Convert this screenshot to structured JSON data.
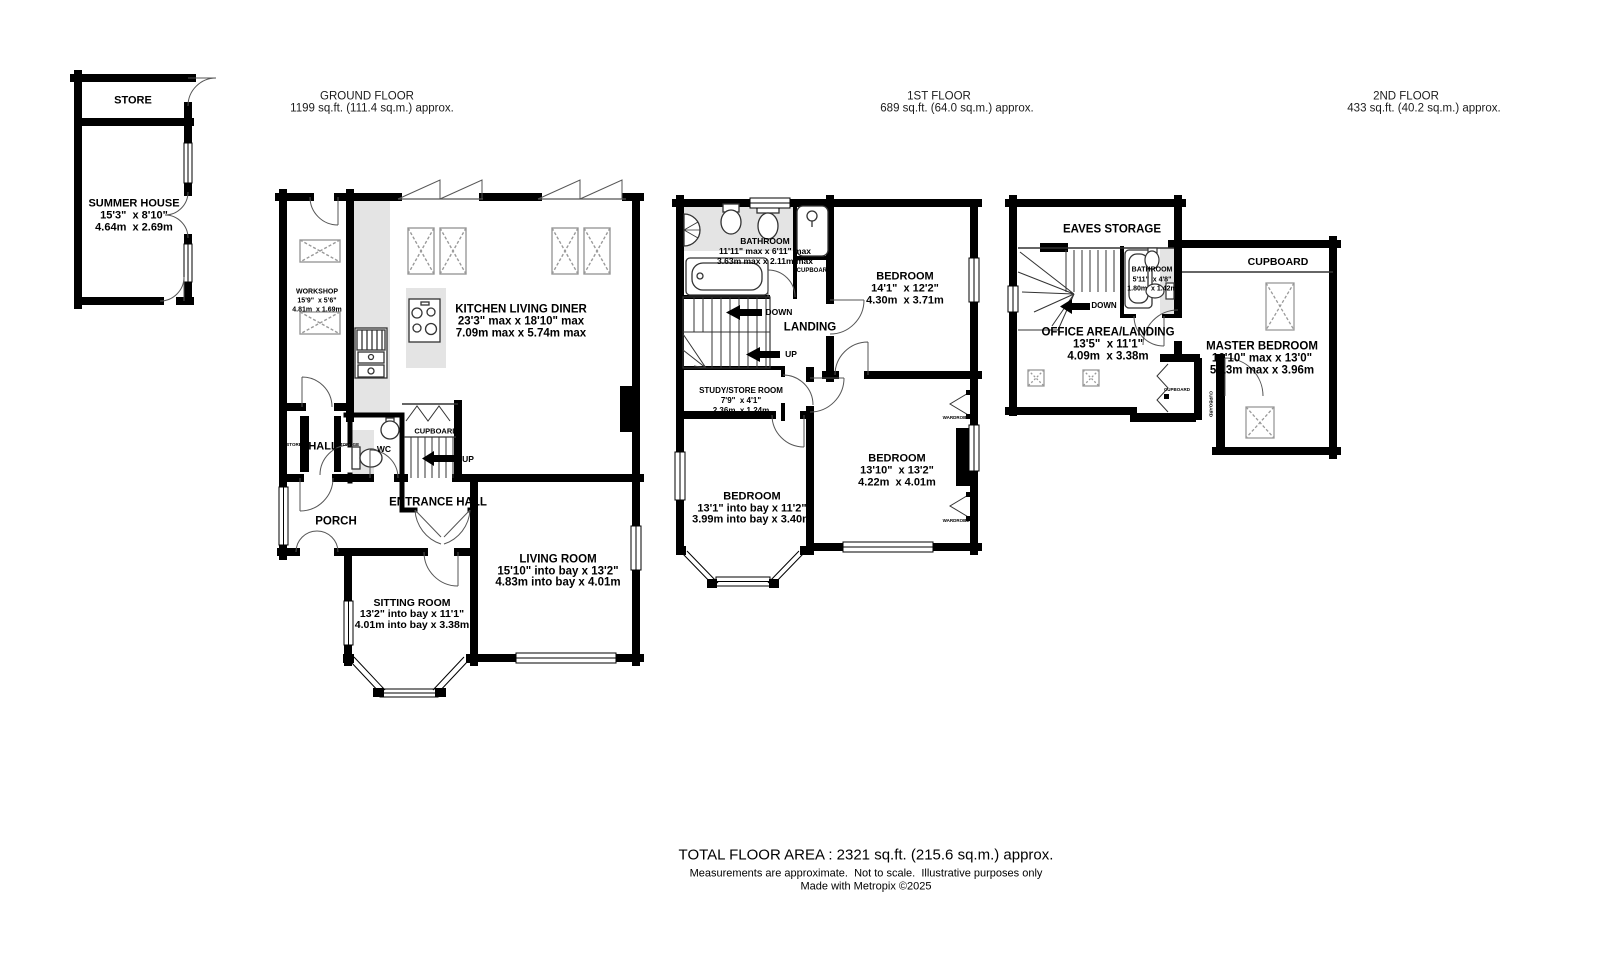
{
  "headers": {
    "ground": {
      "title": "GROUND FLOOR",
      "area": "1199 sq.ft. (111.4 sq.m.) approx."
    },
    "first": {
      "title": "1ST FLOOR",
      "area": "689 sq.ft. (64.0 sq.m.) approx."
    },
    "second": {
      "title": "2ND FLOOR",
      "area": "433 sq.ft. (40.2 sq.m.) approx."
    }
  },
  "outbuilding": {
    "store": "STORE",
    "summer_house": {
      "name": "SUMMER HOUSE",
      "dims_ft": "15'3\"  x 8'10\"",
      "dims_m": "4.64m  x 2.69m"
    }
  },
  "ground": {
    "workshop": {
      "name": "WORKSHOP",
      "dims_ft": "15'9\"  x 5'6\"",
      "dims_m": "4.81m  x 1.69m"
    },
    "kitchen": {
      "name": "KITCHEN LIVING DINER",
      "dims_ft": "23'3\" max x 18'10\" max",
      "dims_m": "7.09m max x 5.74m max"
    },
    "hall": "HALL",
    "store_closet": "STORE",
    "storage_closet": "STORAGE",
    "wc": "WC",
    "cupboard": "CUPBOARD",
    "up": "UP",
    "entrance_hall": "ENTRANCE HALL",
    "porch": "PORCH",
    "sitting": {
      "name": "SITTING ROOM",
      "dims_ft": "13'2\" into bay x 11'1\"",
      "dims_m": "4.01m into bay x 3.38m"
    },
    "living": {
      "name": "LIVING ROOM",
      "dims_ft": "15'10\" into bay x 13'2\"",
      "dims_m": "4.83m into bay x 4.01m"
    }
  },
  "first": {
    "bathroom": {
      "name": "BATHROOM",
      "dims_ft": "11'11\" max x 6'11\" max",
      "dims_m": "3.63m max x 2.11m max"
    },
    "cupboard": "CUPBOARD",
    "down": "DOWN",
    "up": "UP",
    "landing": "LANDING",
    "study": {
      "name": "STUDY/STORE ROOM",
      "dims_ft": "7'9\"  x 4'1\"",
      "dims_m": "2.36m  x 1.24m"
    },
    "bedroom1": {
      "name": "BEDROOM",
      "dims_ft": "14'1\"  x 12'2\"",
      "dims_m": "4.30m  x 3.71m"
    },
    "bedroom2": {
      "name": "BEDROOM",
      "dims_ft": "13'10\"  x 13'2\"",
      "dims_m": "4.22m  x 4.01m"
    },
    "bedroom3": {
      "name": "BEDROOM",
      "dims_ft": "13'1\" into bay x 11'2\"",
      "dims_m": "3.99m into bay x 3.40m"
    },
    "wardrobe": "WARDROBE"
  },
  "second": {
    "eaves": "EAVES STORAGE",
    "down": "DOWN",
    "bathroom": {
      "name": "BATHROOM",
      "dims_ft": "5'11\"  x 4'8\"",
      "dims_m": "1.80m  x 1.42m"
    },
    "office": {
      "name": "OFFICE AREA/LANDING",
      "dims_ft": "13'5\"  x 11'1\"",
      "dims_m": "4.09m  x 3.38m"
    },
    "cupboard": "CUPBOARD",
    "cupboard_small": "CUPBOARD",
    "master": {
      "name": "MASTER BEDROOM",
      "dims_ft": "16'10\" max x 13'0\"",
      "dims_m": "5.13m max x 3.96m"
    }
  },
  "footer": {
    "total": "TOTAL FLOOR AREA : 2321 sq.ft. (215.6 sq.m.) approx.",
    "disclaimer": "Measurements are approximate.  Not to scale.  Illustrative purposes only",
    "credit": "Made with Metropix ©2025"
  },
  "colors": {
    "wall": "#000000",
    "floor_gray": "#e4e4e4"
  }
}
